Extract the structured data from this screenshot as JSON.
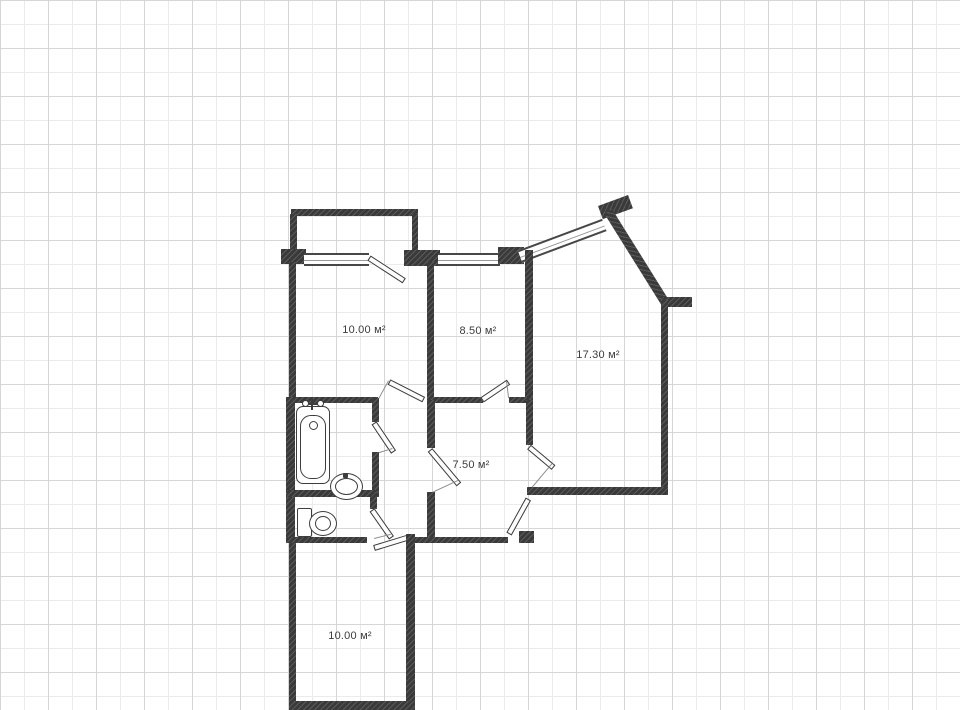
{
  "plan": {
    "type": "floor-plan",
    "rooms": [
      {
        "name": "room-top-left",
        "area_label": "10.00 м²"
      },
      {
        "name": "room-top-middle",
        "area_label": "8.50 м²"
      },
      {
        "name": "room-right",
        "area_label": "17.30 м²"
      },
      {
        "name": "hallway",
        "area_label": "7.50 м²"
      },
      {
        "name": "room-bottom",
        "area_label": "10.00 м²"
      }
    ],
    "fixtures": [
      "bathtub-icon",
      "sink-icon",
      "toilet-icon"
    ],
    "colors": {
      "wall": "#3a3a3a",
      "window_line": "#474747",
      "door_swing_line": "#8d8d8d",
      "grid_minor": "#ebebeb",
      "grid_major": "#d6d6d6",
      "background": "#ffffff",
      "label_text": "#3c3c3c"
    }
  }
}
